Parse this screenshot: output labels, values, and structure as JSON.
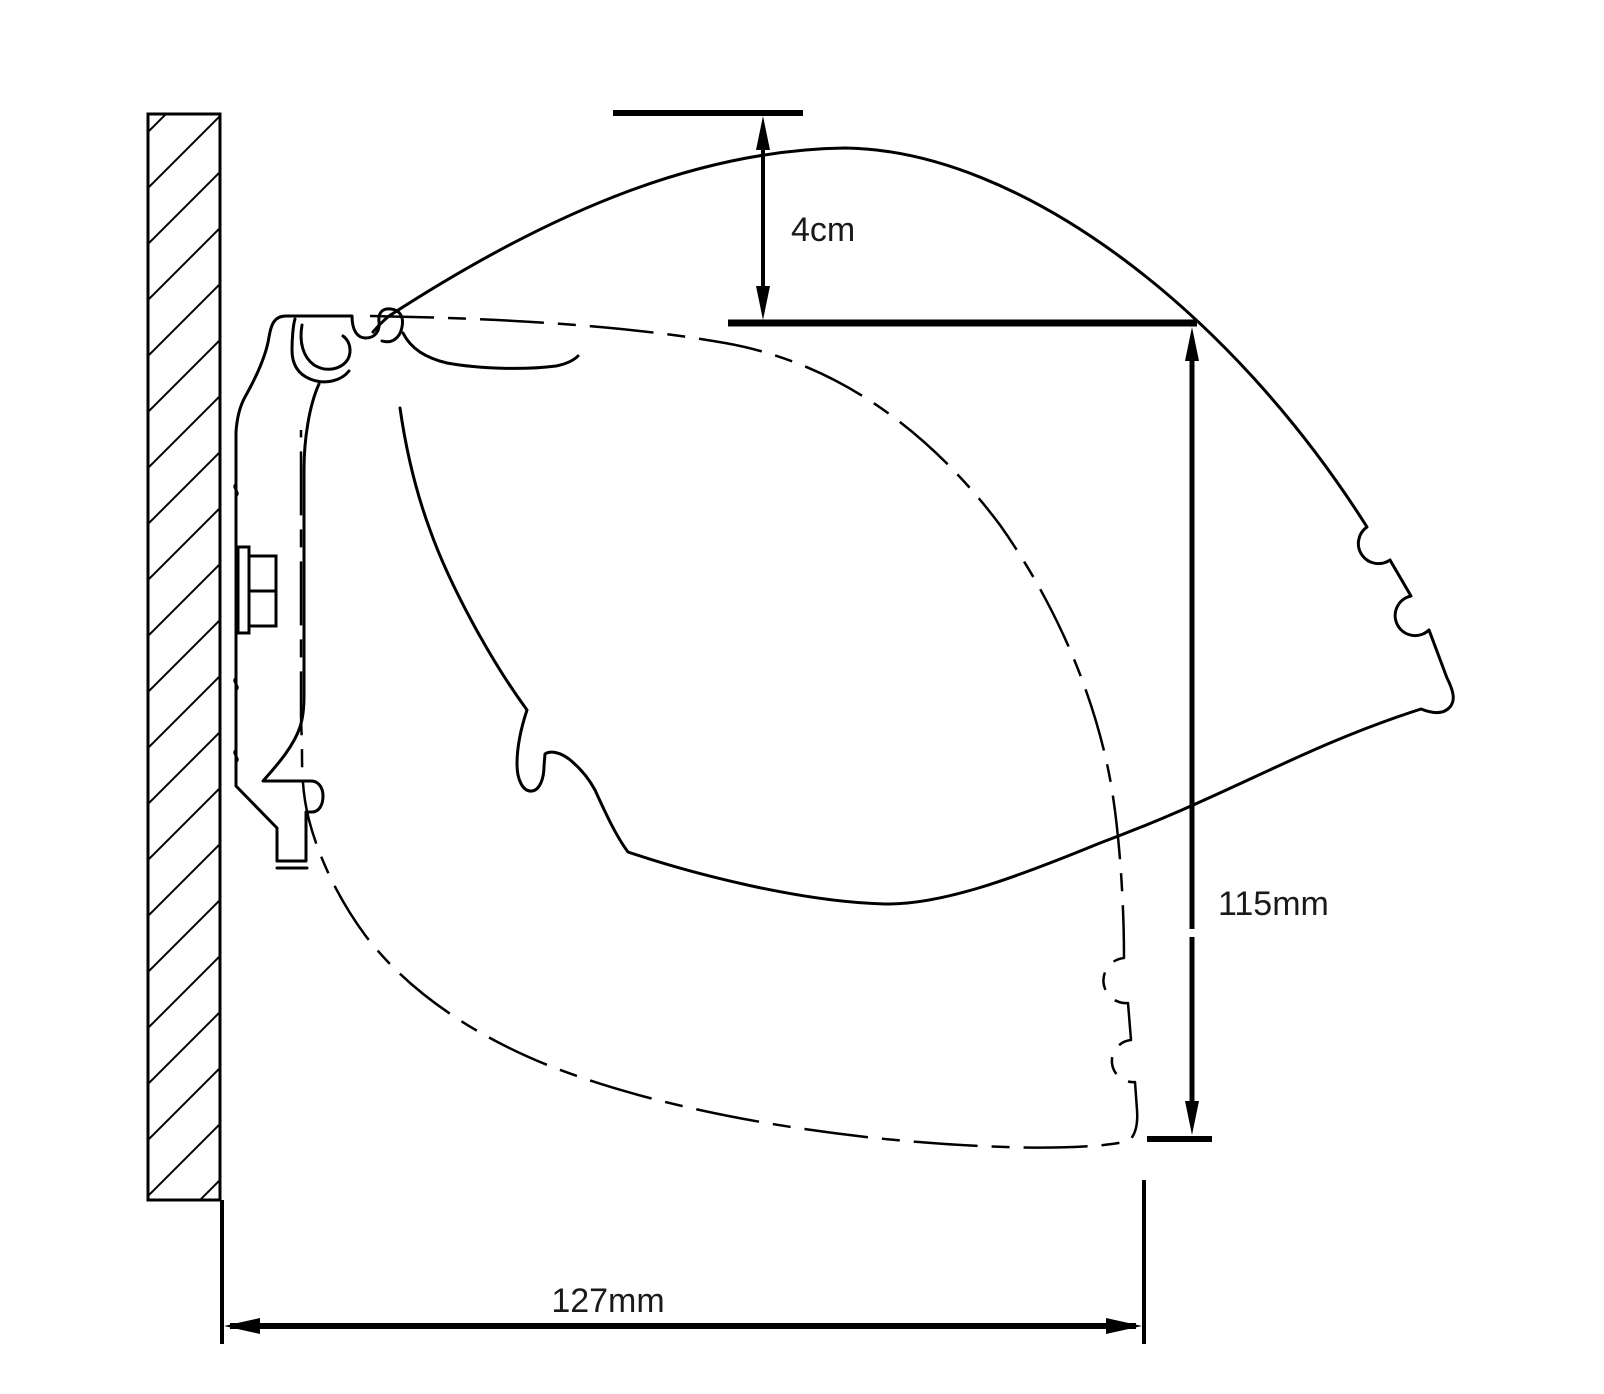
{
  "drawing": {
    "kind": "technical-cross-section",
    "background": "#ffffff",
    "line_color": "#000000",
    "dimensions": {
      "gap": {
        "label": "4cm"
      },
      "height": {
        "label": "115mm"
      },
      "depth": {
        "label": "127mm"
      }
    }
  }
}
